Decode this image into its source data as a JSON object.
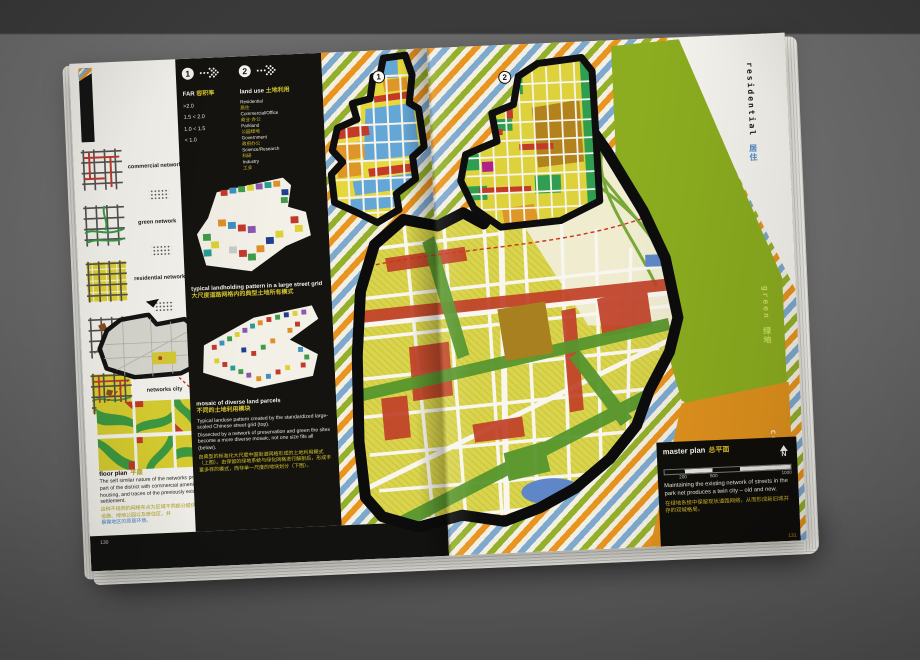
{
  "book": {
    "pages": {
      "left_number": "130",
      "right_number": "131"
    }
  },
  "networks": {
    "items": [
      {
        "label": "commercial network"
      },
      {
        "label": "green network"
      },
      {
        "label": "residential network"
      },
      {
        "label": "existing villages + roads networks"
      },
      {
        "label": "networks city"
      }
    ]
  },
  "legend_far": {
    "number": "1",
    "title_en": "FAR",
    "title_zh": "容积率",
    "values": [
      ">2.0",
      "1.5 < 2.0",
      "1.0 < 1.5",
      "< 1.0"
    ]
  },
  "legend_landuse": {
    "number": "2",
    "title_en": "land use",
    "title_zh": "土地利用",
    "entries": [
      {
        "en": "Residential",
        "zh": "居住"
      },
      {
        "en": "Commercial/Office",
        "zh": "商业·办公"
      },
      {
        "en": "Parkland",
        "zh": "公园绿地"
      },
      {
        "en": "Government",
        "zh": "政府办公"
      },
      {
        "en": "Science/Research",
        "zh": "科研"
      },
      {
        "en": "Industry",
        "zh": "工业"
      }
    ]
  },
  "landholding": {
    "caption_en": "typical landholding pattern in a large street grid",
    "caption_zh": "大尺度道路网格内的典型土地所有模式"
  },
  "mosaic": {
    "caption_en": "mosaic of diverse land parcels",
    "caption_zh": "不同的土地利用模块",
    "body_en_1": "Typical landuse pattern created by the standardized large-scaled Chinese street grid (top).",
    "body_en_2": "Dissected by a network of preservation and green the sites become a more diverse mosaic, not one size fits all (below).",
    "body_zh": "由典型的标准化大尺度中国街道网格形成的土地利用模式（上图）。由保留的绿地系统与绿化网格进行解剖后，形成丰富多样的模式，而非单一尺度的地块划分（下图）。"
  },
  "floorplan": {
    "title_en": "floor plan",
    "title_zh": "平面",
    "body_en": "The self similar nature of the networks provides each part of the district with commercial amenity, parks, housing, and traces of the previously existing settlement.",
    "body_zh": "这种不规则的网络布点为区域不同部分提供了宜人的商业设施、绿地公园以及原住区，并",
    "body_zh_blue": "暴露地区的原居环境。"
  },
  "masterplan": {
    "title_en": "master plan",
    "title_zh": "总平面",
    "north_label": "N",
    "scale_labels": [
      "200",
      "500",
      "1000"
    ],
    "body_en": "Maintaining the existing network of streets in the park net produces a twin city – old and new.",
    "body_zh": "在绿地系统中保留现状道路网络，从而形成新旧城并存的双城格局。"
  },
  "map_markers": {
    "map1": "1",
    "map2": "2"
  },
  "edge_tabs": [
    {
      "en": "residential",
      "zh": "居住"
    },
    {
      "en": "green",
      "zh": "绿地"
    },
    {
      "en": "commercial",
      "zh": "商业"
    }
  ],
  "colors": {
    "stripe_orange": "#e8941f",
    "stripe_green": "#94b02a",
    "stripe_blue": "#7ea9cf",
    "accent_yellow": "#d2c32d",
    "panel_black": "#15130f",
    "field_green": "#8cad1f",
    "field_orange": "#e0921d",
    "tab_blue": "#4a87c8"
  }
}
